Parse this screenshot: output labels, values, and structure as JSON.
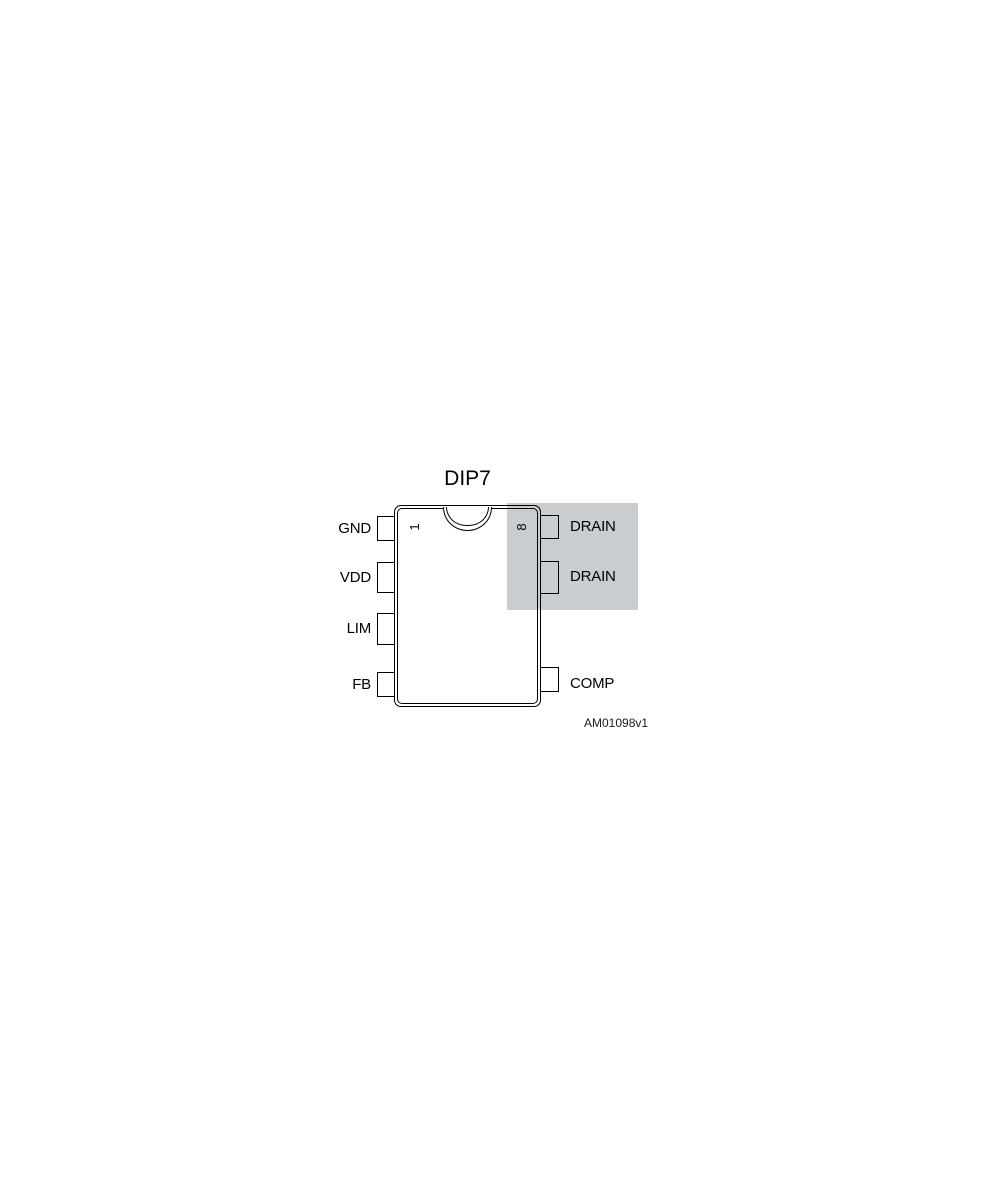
{
  "figure": {
    "title": "DIP7",
    "reference": "AM01098v1"
  },
  "pins": {
    "left": [
      {
        "label": "GND",
        "number": "1"
      },
      {
        "label": "VDD"
      },
      {
        "label": "LIM"
      },
      {
        "label": "FB"
      }
    ],
    "right": [
      {
        "label": "DRAIN",
        "number": "8"
      },
      {
        "label": "DRAIN"
      },
      {
        "label": "COMP"
      }
    ]
  },
  "colors": {
    "highlight": "#c9cdd0"
  }
}
